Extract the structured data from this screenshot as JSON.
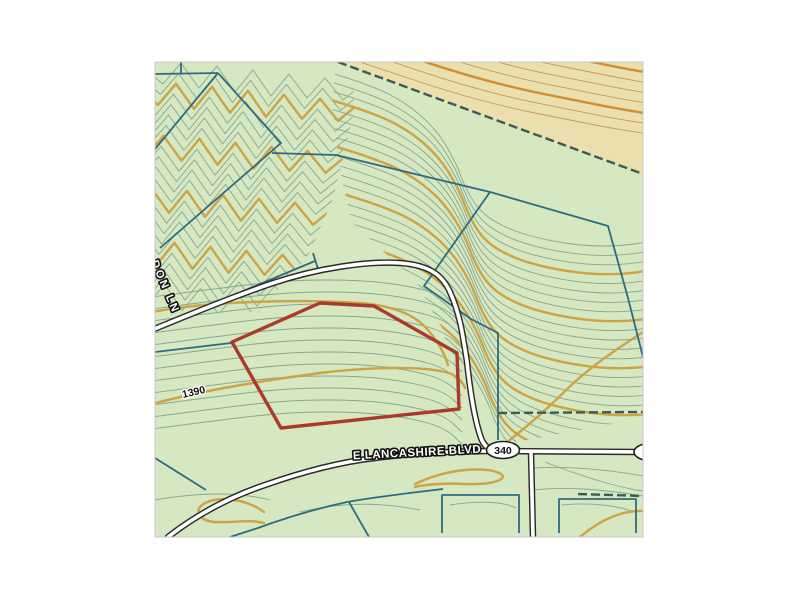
{
  "map": {
    "labels": {
      "street_main": "E LANCASHIRE BLVD",
      "street_side": "DON LN",
      "route_marker": "340",
      "contour_elevation": "1390"
    },
    "colors": {
      "frame_bg": "#ffffff",
      "land": "#d5e8c1",
      "land_alt": "#ebdfae",
      "contour_minor": "#87a690",
      "contour_minor_alt": "#c49a56",
      "contour_index": "#cda344",
      "contour_index_alt": "#cf8f33",
      "parcel_line": "#2f6b80",
      "boundary_dash": "#3d5a55",
      "road_fill": "#ffffff",
      "road_casing": "#2b2b2b",
      "parcel_highlight": "#ab3a2c",
      "label_fill": "#ffffff",
      "label_halo": "#111111",
      "map_border": "#c8c8c8"
    }
  }
}
